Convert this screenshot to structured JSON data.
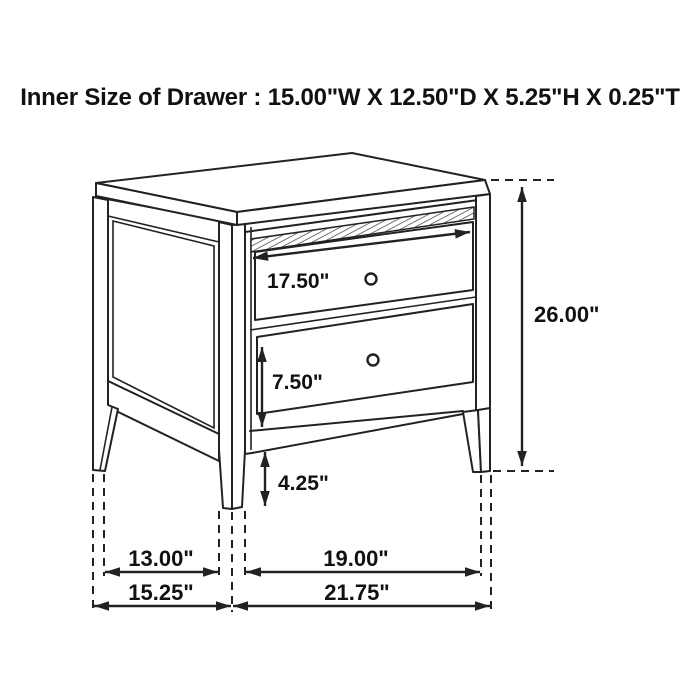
{
  "title": "Inner Size of Drawer : 15.00\"W X 12.50\"D X 5.25\"H X 0.25\"T",
  "dimension_labels": {
    "drawer_width": "17.50\"",
    "overall_height": "26.00\"",
    "lower_drawer_height": "7.50\"",
    "leg_height": "4.25\"",
    "inner_depth": "13.00\"",
    "inner_width": "19.00\"",
    "overall_depth": "15.25\"",
    "overall_width": "21.75\""
  },
  "colors": {
    "line": "#222222",
    "text": "#111111",
    "background": "#ffffff"
  }
}
